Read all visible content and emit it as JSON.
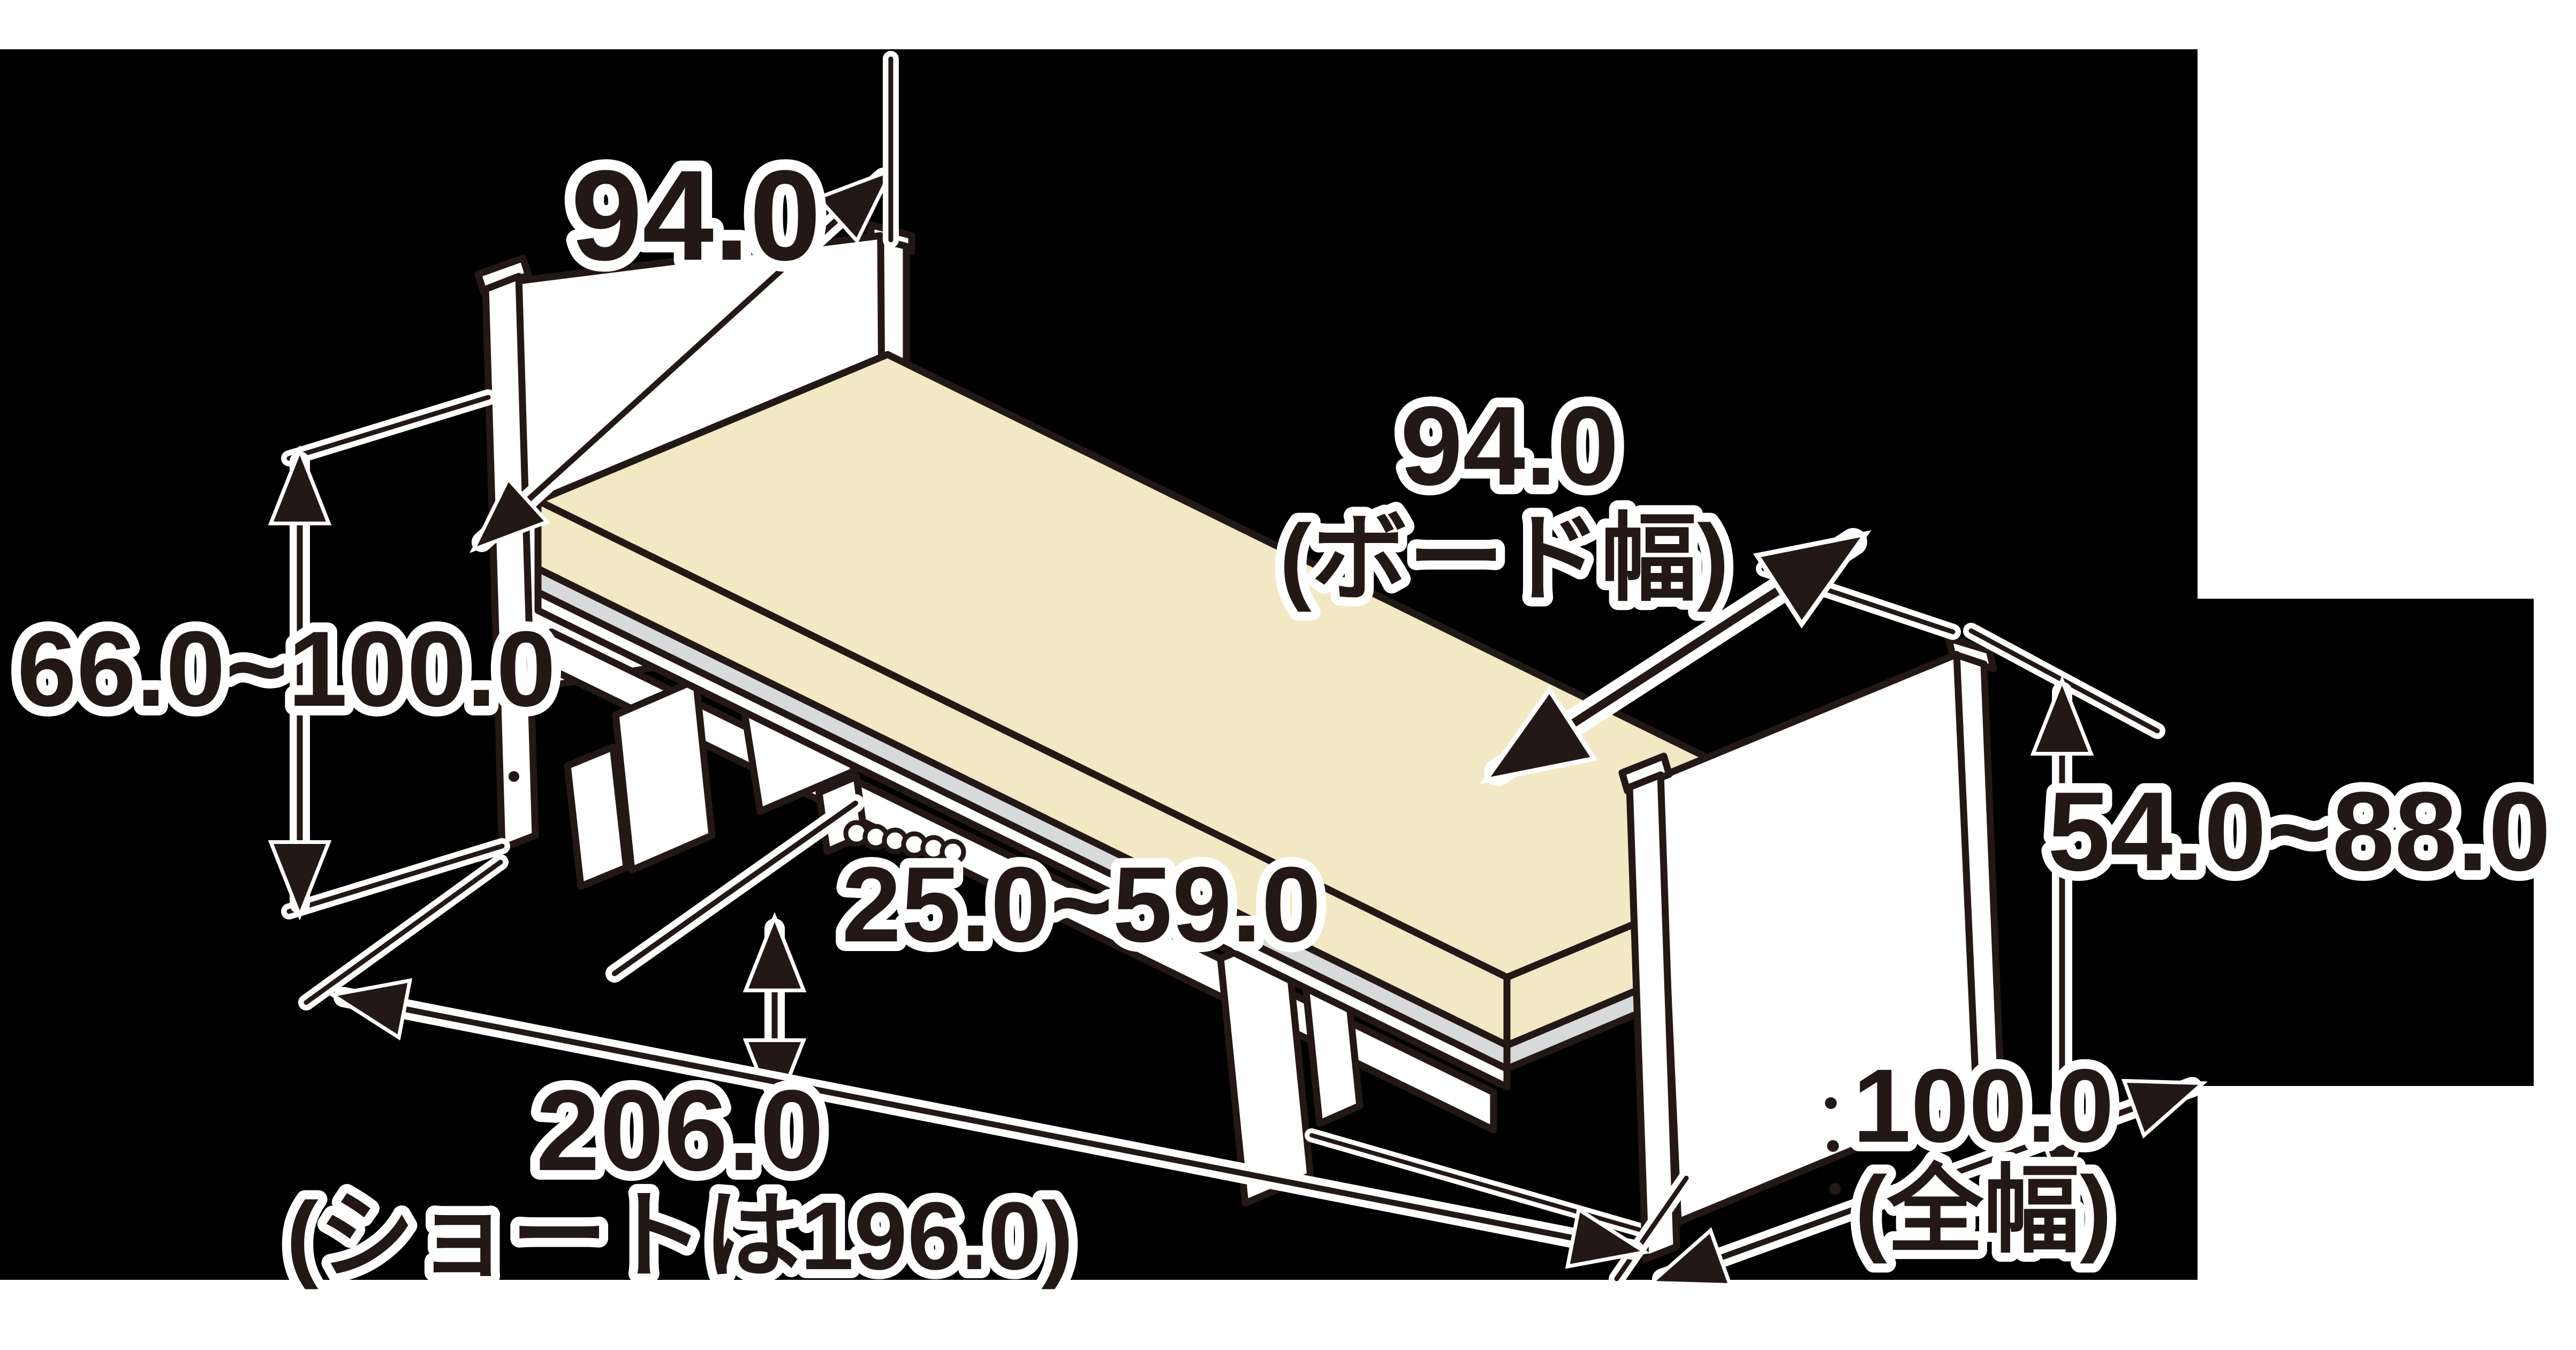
{
  "diagram": {
    "description": "Isometric line drawing of an adjustable electric care bed with dimension callouts (cm)",
    "colors": {
      "background": "#000000",
      "line_dark": "#231815",
      "mattress_cream": "#f2e8c4",
      "deck_gray": "#d8d9da",
      "surface_white": "#ffffff"
    },
    "labels": {
      "headboard_width": "94.0",
      "board_width_value": "94.0",
      "board_width_caption": "(ボード幅)",
      "headboard_height_range": "66.0~100.0",
      "under_bed_clearance": "25.0~59.0",
      "length_value": "206.0",
      "length_caption": "(ショートは196.0)",
      "footboard_height_range": "54.0~88.0",
      "overall_width_value": "100.0",
      "overall_width_caption": "(全幅)"
    }
  }
}
